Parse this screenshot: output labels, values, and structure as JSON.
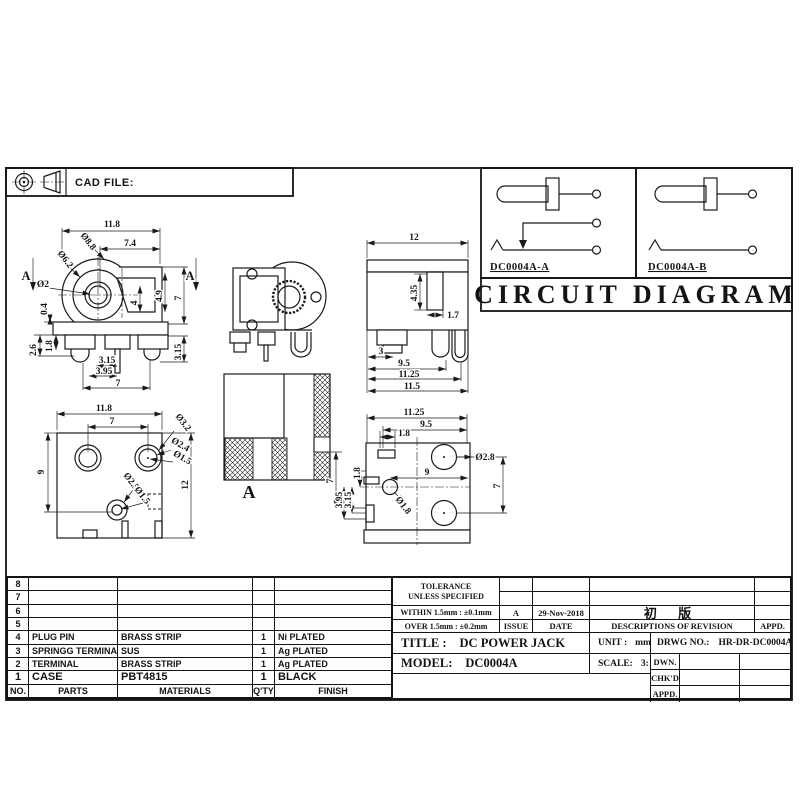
{
  "colors": {
    "paper": "#ffffff",
    "ink": "#1a1a1a"
  },
  "header": {
    "cad_file_label": "CAD FILE:",
    "projection_icon": "third-angle-projection-symbol"
  },
  "circuit": {
    "title": "CIRCUIT DIAGRAM",
    "panels": [
      {
        "label": "DC0004A-A",
        "type": "jack-with-switch-contact"
      },
      {
        "label": "DC0004A-B",
        "type": "jack-two-terminal"
      }
    ]
  },
  "views": {
    "front": {
      "dims": [
        {
          "t": "11.8",
          "x": 112,
          "y": 227
        },
        {
          "t": "7.4",
          "x": 130,
          "y": 246
        },
        {
          "t": "Ø8.8",
          "x": 86,
          "y": 243,
          "r": 52
        },
        {
          "t": "Ø6.2",
          "x": 63,
          "y": 261,
          "r": 52
        },
        {
          "t": "Ø2",
          "x": 43,
          "y": 287
        },
        {
          "t": "4.9",
          "x": 162,
          "y": 296,
          "r": -90
        },
        {
          "t": "4",
          "x": 137,
          "y": 303,
          "r": -90
        },
        {
          "t": "7",
          "x": 181,
          "y": 298,
          "r": -90
        },
        {
          "t": "3.15",
          "x": 181,
          "y": 352,
          "r": -90
        },
        {
          "t": "0.4",
          "x": 47,
          "y": 309,
          "r": -90
        },
        {
          "t": "2.6",
          "x": 36,
          "y": 350,
          "r": -90
        },
        {
          "t": "1.8",
          "x": 52,
          "y": 346,
          "r": -90
        },
        {
          "t": "3.15",
          "x": 107,
          "y": 363
        },
        {
          "t": "3.95",
          "x": 104,
          "y": 374
        },
        {
          "t": "7",
          "x": 118,
          "y": 386
        },
        {
          "t": "A",
          "x": 26,
          "y": 280,
          "cls": "marker"
        },
        {
          "t": "A",
          "x": 190,
          "y": 280,
          "cls": "marker"
        }
      ]
    },
    "perspective": {
      "dims": []
    },
    "side": {
      "dims": [
        {
          "t": "12",
          "x": 414,
          "y": 240
        },
        {
          "t": "4.35",
          "x": 417,
          "y": 293,
          "r": -90
        },
        {
          "t": "1.7",
          "x": 453,
          "y": 318
        },
        {
          "t": "3",
          "x": 381,
          "y": 354
        },
        {
          "t": "9.5",
          "x": 404,
          "y": 366
        },
        {
          "t": "11.25",
          "x": 409,
          "y": 377
        },
        {
          "t": "11.5",
          "x": 412,
          "y": 389
        }
      ]
    },
    "bottom": {
      "dims": [
        {
          "t": "11.8",
          "x": 104,
          "y": 411
        },
        {
          "t": "7",
          "x": 112,
          "y": 424
        },
        {
          "t": "Ø3.2",
          "x": 181,
          "y": 424,
          "r": 52
        },
        {
          "t": "Ø2.4",
          "x": 179,
          "y": 447,
          "r": 30
        },
        {
          "t": "Ø1.5",
          "x": 181,
          "y": 460,
          "r": 30
        },
        {
          "t": "Ø2.5",
          "x": 129,
          "y": 483,
          "r": 52
        },
        {
          "t": "Ø1.5",
          "x": 140,
          "y": 497,
          "r": 52
        },
        {
          "t": "9",
          "x": 44,
          "y": 472,
          "r": -90
        },
        {
          "t": "12",
          "x": 188,
          "y": 485,
          "r": -90
        }
      ]
    },
    "section": {
      "dims": [
        {
          "t": "A",
          "x": 249,
          "y": 498,
          "cls": "big"
        },
        {
          "t": "7",
          "x": 333,
          "y": 481,
          "r": -90
        },
        {
          "t": "3.95",
          "x": 342,
          "y": 500,
          "r": -90
        },
        {
          "t": "3.15",
          "x": 351,
          "y": 500,
          "r": -90
        },
        {
          "t": "1.8",
          "x": 360,
          "y": 473,
          "r": -90
        }
      ]
    },
    "footprint": {
      "dims": [
        {
          "t": "11.25",
          "x": 414,
          "y": 415
        },
        {
          "t": "9.5",
          "x": 426,
          "y": 427
        },
        {
          "t": "1.8",
          "x": 404,
          "y": 436
        },
        {
          "t": "Ø2.8",
          "x": 485,
          "y": 460
        },
        {
          "t": "9",
          "x": 427,
          "y": 475
        },
        {
          "t": "Ø1.8",
          "x": 401,
          "y": 507,
          "r": 52
        },
        {
          "t": "7",
          "x": 500,
          "y": 486,
          "r": -90
        }
      ]
    }
  },
  "parts_table": {
    "headers": {
      "no": "NO.",
      "parts": "PARTS",
      "materials": "MATERIALS",
      "qty": "Q'TY",
      "finish": "FINISH"
    },
    "rows": [
      {
        "no": "8",
        "parts": "",
        "materials": "",
        "qty": "",
        "finish": ""
      },
      {
        "no": "7",
        "parts": "",
        "materials": "",
        "qty": "",
        "finish": ""
      },
      {
        "no": "6",
        "parts": "",
        "materials": "",
        "qty": "",
        "finish": ""
      },
      {
        "no": "5",
        "parts": "",
        "materials": "",
        "qty": "",
        "finish": ""
      },
      {
        "no": "4",
        "parts": "PLUG PIN",
        "materials": "BRASS STRIP",
        "qty": "1",
        "finish": "Ni PLATED"
      },
      {
        "no": "3",
        "parts": "SPRINGG TERMINAL",
        "materials": "SUS",
        "qty": "1",
        "finish": "Ag PLATED"
      },
      {
        "no": "2",
        "parts": "TERMINAL",
        "materials": "BRASS STRIP",
        "qty": "1",
        "finish": "Ag PLATED"
      },
      {
        "no": "1",
        "parts": "CASE",
        "materials": "PBT4815",
        "qty": "1",
        "finish": "BLACK"
      }
    ]
  },
  "title_block": {
    "tolerance_line1": "TOLERANCE",
    "tolerance_line2": "UNLESS  SPECIFIED",
    "tolerance_within": "WITHIN 1.5mm : ±0.1mm",
    "tolerance_over": "OVER 1.5mm : ±0.2mm",
    "issue_value": "A",
    "issue_label": "ISSUE",
    "date_value": "29-Nov-2018",
    "date_label": "DATE",
    "revision_value": "初 版",
    "revision_label": "DESCRIPTIONS  OF  REVISION",
    "appd_label": "APPD.",
    "title_label": "TITLE :",
    "title_value": "DC POWER JACK",
    "model_label": "MODEL:",
    "model_value": "DC0004A",
    "unit_label": "UNIT :",
    "unit_value": "mm",
    "scale_label": "SCALE:",
    "scale_value": "3:1",
    "drwg_label": "DRWG NO.:",
    "drwg_value": "HR-DR-DC0004A-00",
    "dwn_label": "DWN.",
    "chkd_label": "CHK'D",
    "appd2_label": "APPD."
  }
}
